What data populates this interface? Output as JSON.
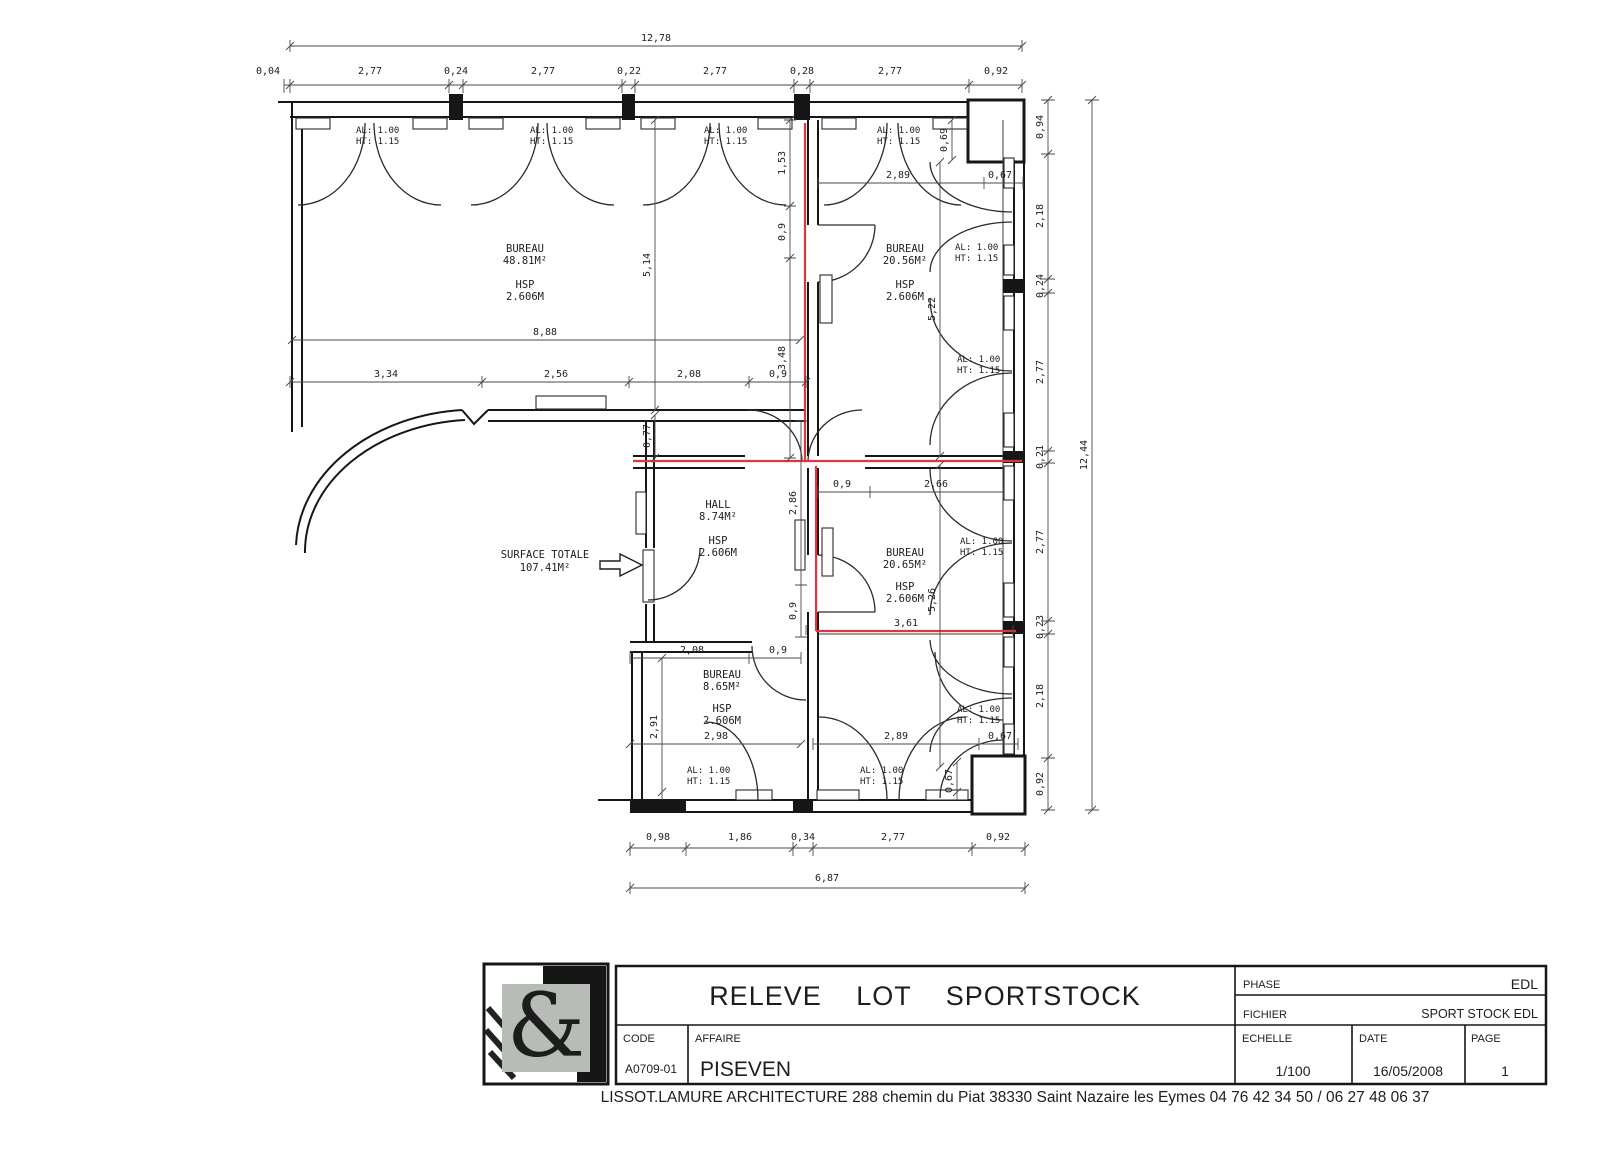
{
  "colors": {
    "paper": "#ffffff",
    "ink": "#161616",
    "boundary": "#de3540",
    "logo_gray": "#b7bcb6",
    "logo_glyph_gray": "#ced3cb"
  },
  "plan": {
    "surface": {
      "label": "SURFACE TOTALE",
      "value": "107.41M²"
    },
    "win": {
      "al": "AL: 1.00",
      "ht": "HT: 1.15"
    },
    "rooms": [
      {
        "label": "BUREAU",
        "area": "48.81M²",
        "hsp": "HSP",
        "height": "2.606M"
      },
      {
        "label": "BUREAU",
        "area": "20.56M²",
        "hsp": "HSP",
        "height": "2.606M"
      },
      {
        "label": "HALL",
        "area": "8.74M²",
        "hsp": "HSP",
        "height": "2.606M"
      },
      {
        "label": "BUREAU",
        "area": "20.65M²",
        "hsp": "HSP",
        "height": "2.606M"
      },
      {
        "label": "BUREAU",
        "area": "8.65M²",
        "hsp": "HSP",
        "height": "2.606M"
      }
    ],
    "dims": {
      "top_total": "12,78",
      "top": [
        "0,04",
        "2,77",
        "0,24",
        "2,77",
        "0,22",
        "2,77",
        "0,28",
        "2,77",
        "0,92"
      ],
      "right_total": "12,44",
      "right": [
        "0,94",
        "2,18",
        "0,24",
        "2,77",
        "0,21",
        "2,77",
        "0,23",
        "2,18",
        "0,92"
      ],
      "bottom": [
        "0,98",
        "1,86",
        "0,34",
        "2,77",
        "0,92"
      ],
      "bottom_total": "6,87",
      "i": {
        "w888": "8,88",
        "v514": "5,14",
        "h334": "3,34",
        "h256": "2,56",
        "h208a": "2,08",
        "h09a": "0,9",
        "v153": "1,53",
        "v09b": "0,9",
        "v348": "3,48",
        "v077": "0,77",
        "h289a": "2,89",
        "h067a": "0,67",
        "v069": "0,69",
        "v522": "5,22",
        "h09c": "0,9",
        "h266": "2,66",
        "v286": "2,86",
        "v09d": "0,9",
        "v526": "5,26",
        "h361": "3,61",
        "h208b": "2,08",
        "h09e": "0,9",
        "v291": "2,91",
        "h298": "2,98",
        "h289b": "2,89",
        "h067b": "0,67",
        "v067": "0,67"
      }
    }
  },
  "title_block": {
    "title": "RELEVE LOT SPORTSTOCK",
    "phase_label": "PHASE",
    "phase_value": "EDL",
    "fichier_label": "FICHIER",
    "fichier_value": "SPORT STOCK EDL",
    "code_label": "CODE",
    "code_value": "A0709-01",
    "affaire_label": "AFFAIRE",
    "affaire_value": "PISEVEN",
    "echelle_label": "ECHELLE",
    "echelle_value": "1/100",
    "date_label": "DATE",
    "date_value": "16/05/2008",
    "page_label": "PAGE",
    "page_value": "1",
    "logo_glyph": "&"
  },
  "footer": {
    "text": "LISSOT.LAMURE ARCHITECTURE 288 chemin du Piat 38330 Saint Nazaire les Eymes  04 76 42 34 50 / 06 27 48 06 37"
  }
}
